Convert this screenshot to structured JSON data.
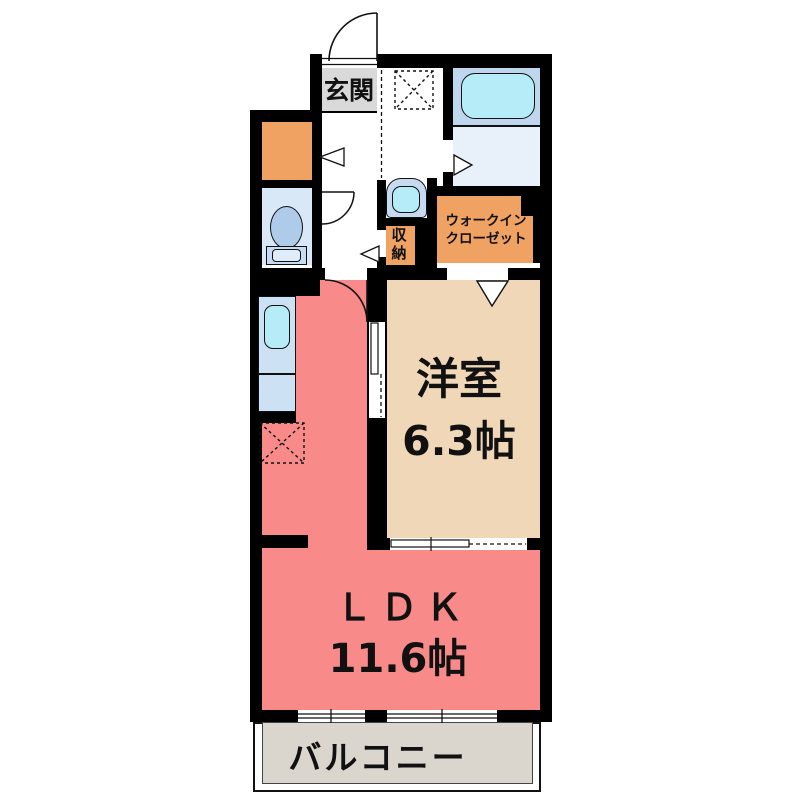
{
  "rooms": {
    "entrance": {
      "label": "玄関"
    },
    "closet": {
      "label": "収納"
    },
    "walk_in_closet": {
      "line1": "ウォークイン",
      "line2": "クローゼット"
    },
    "western_room": {
      "label": "洋室",
      "size": "6.3帖"
    },
    "ldk": {
      "label": "ＬＤＫ",
      "size": "11.6帖"
    },
    "balcony": {
      "label": "バルコニー"
    }
  },
  "fixtures": [
    "bathtub",
    "toilet",
    "washbasin",
    "kitchen-sink",
    "kitchen-counter",
    "washing-machine-space",
    "refrigerator-space",
    "entrance-door",
    "sliding-door",
    "window"
  ],
  "colors": {
    "wall": "#000000",
    "ldk_floor": "#f98a8a",
    "western_room_floor": "#f0d7b7",
    "closet_orange": "#f0a263",
    "entrance_gray": "#d9d9d9",
    "balcony_gray": "#dad6ce",
    "bath_blue": "#bfd7ee",
    "water_cyan": "#b5ecf8",
    "toilet_room_blue": "#d9e8f7"
  }
}
